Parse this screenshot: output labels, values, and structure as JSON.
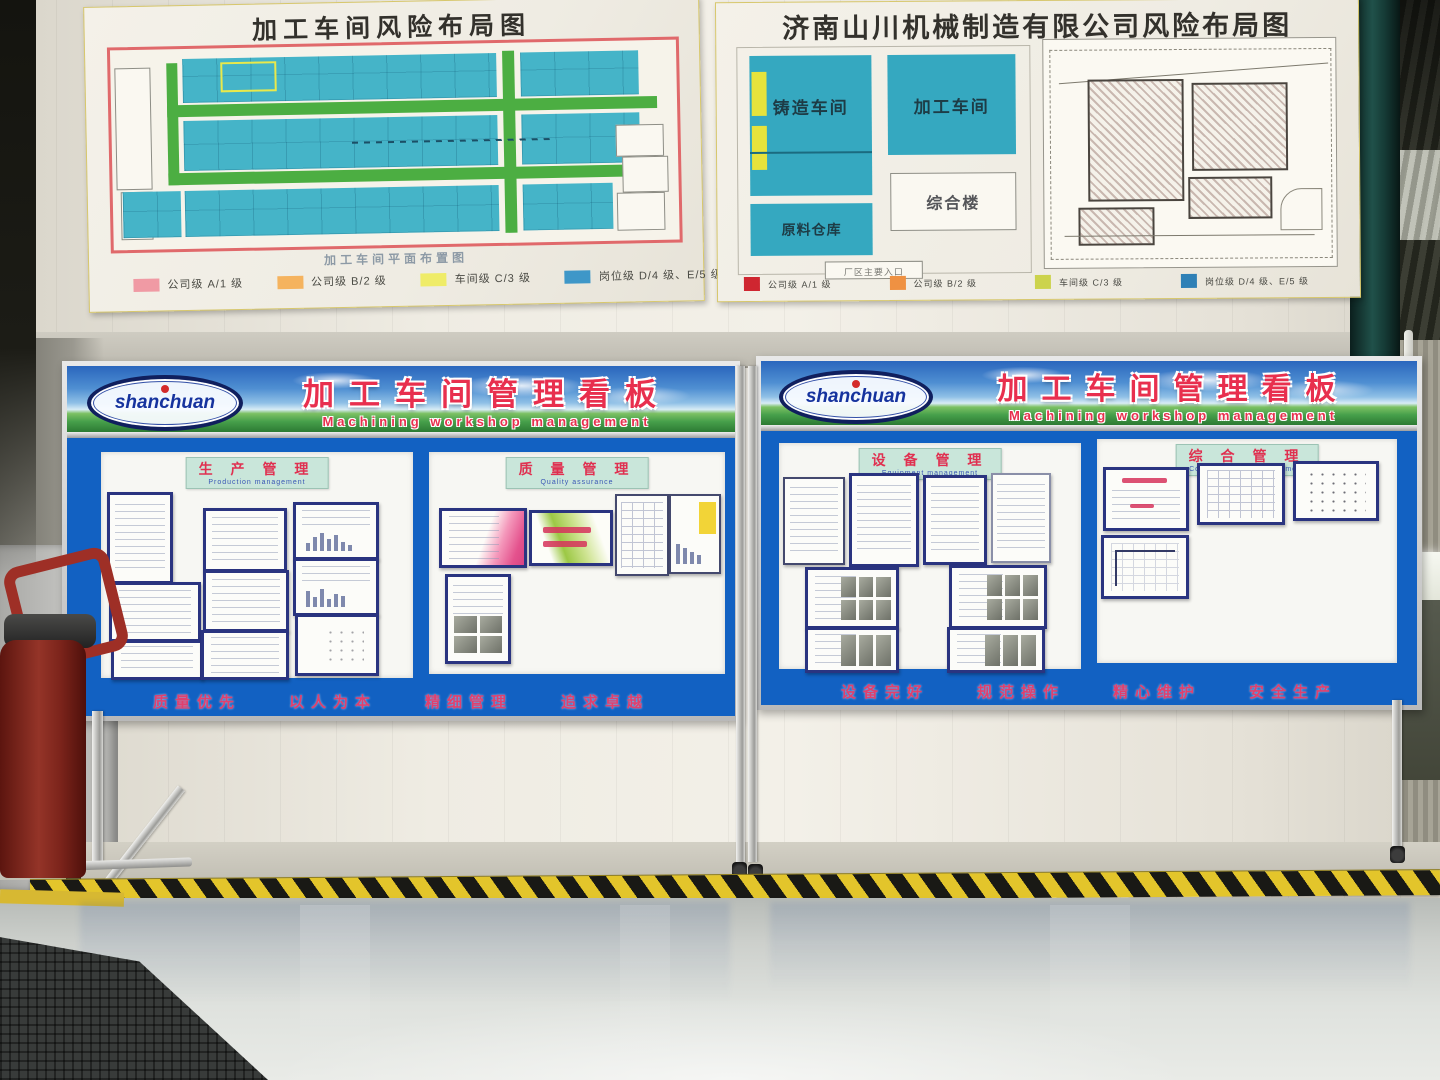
{
  "posters": {
    "left": {
      "title": "加工车间风险布局图",
      "caption": "加工车间平面布置图",
      "legend": [
        {
          "color": "#f09aa4",
          "label": "公司级  A/1 级"
        },
        {
          "color": "#f5b35e",
          "label": "公司级  B/2 级"
        },
        {
          "color": "#efec68",
          "label": "车间级  C/3 级"
        },
        {
          "color": "#3e97c8",
          "label": "岗位级  D/4 级、E/5 级"
        }
      ]
    },
    "right": {
      "title": "济南山川机械制造有限公司风险布局图",
      "blocks": {
        "casting": "铸造车间",
        "machining": "加工车间",
        "office": "综合楼",
        "warehouse": "原料仓库"
      },
      "entrance": "厂区主要入口",
      "legend": [
        {
          "color": "#cf2630",
          "label": "公司级 A/1 级"
        },
        {
          "color": "#ef9142",
          "label": "公司级 B/2 级"
        },
        {
          "color": "#ccd34d",
          "label": "车间级 C/3 级"
        },
        {
          "color": "#2f80b6",
          "label": "岗位级 D/4 级、E/5 级"
        }
      ]
    }
  },
  "kanban": {
    "title": "加工车间管理看板",
    "subtitle": "Machining workshop management",
    "logo": "shanchuan"
  },
  "board_left": {
    "sections": [
      {
        "cn": "生 产 管 理",
        "en": "Production management"
      },
      {
        "cn": "质 量 管 理",
        "en": "Quality assurance"
      }
    ],
    "slogan": [
      "质量优先",
      "以人为本",
      "精细管理",
      "追求卓越"
    ]
  },
  "board_right": {
    "sections": [
      {
        "cn": "设 备 管 理",
        "en": "Equipment management"
      },
      {
        "cn": "综 合 管 理",
        "en": "Comprehensive management"
      }
    ],
    "slogan": [
      "设备完好",
      "规范操作",
      "精心维护",
      "安全生产"
    ]
  }
}
